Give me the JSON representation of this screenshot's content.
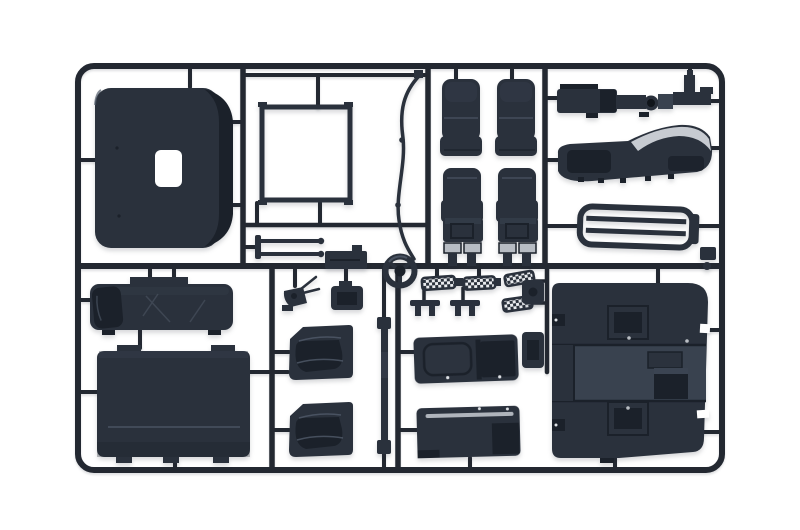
{
  "scene": {
    "type": "photograph",
    "subject": "Plastic scale model kit sprue (injection moulded parts tree) with dark blue-grey styrene truck cab parts on a white background",
    "background": "#ffffff"
  },
  "colors": {
    "background": "#ffffff",
    "runner": "#232831",
    "plastic": "#2a313c",
    "plastic_dark": "#1b212a",
    "plastic_light": "#39424f",
    "sheen": "#515b6a",
    "metal": "#c7cbd1",
    "slider": "#b7bcc3",
    "tread_light": "#e9ebee",
    "tread_dark": "#2a313b"
  },
  "parts": [
    {
      "id": "roof-panel",
      "label": "Cab roof panel with sunroof opening"
    },
    {
      "id": "window-frame",
      "label": "Square window frame seal"
    },
    {
      "id": "thin-rods",
      "label": "Pair of thin wiper-blade rods"
    },
    {
      "id": "small-panel",
      "label": "Small rectangular panel"
    },
    {
      "id": "wiper-rod",
      "label": "Curved antenna / wiper arm rod"
    },
    {
      "id": "steering-wheel",
      "label": "Steering wheel"
    },
    {
      "id": "seat-backrest-left",
      "label": "Seat backrest (left)"
    },
    {
      "id": "seat-backrest-right",
      "label": "Seat backrest (right)"
    },
    {
      "id": "seat-left",
      "label": "Seat with slider base (left)"
    },
    {
      "id": "seat-right",
      "label": "Seat with slider base (right)"
    },
    {
      "id": "chassis-unit",
      "label": "Air tank / chassis cross unit"
    },
    {
      "id": "roof-deflector",
      "label": "Curved roof wind deflector with bright edge"
    },
    {
      "id": "grille",
      "label": "Front grille with horizontal slats"
    },
    {
      "id": "bunk-bed",
      "label": "Sleeper bunk bed with pillow"
    },
    {
      "id": "back-wall",
      "label": "Cab rear wall panel"
    },
    {
      "id": "door-card-upper",
      "label": "Door inner card (upper)"
    },
    {
      "id": "door-card-lower",
      "label": "Door inner card (lower)"
    },
    {
      "id": "trim-strip",
      "label": "Long narrow trim strip"
    },
    {
      "id": "door-shell-upper",
      "label": "Door shell panel (upper)"
    },
    {
      "id": "door-shell-lower",
      "label": "Door shell panel (lower)"
    },
    {
      "id": "cab-floor",
      "label": "Cab floor with engine tunnel and seat platforms"
    },
    {
      "id": "step-plates",
      "label": "Checker tread-plate entry steps (4)"
    },
    {
      "id": "pedal-unit",
      "label": "Pedal unit"
    },
    {
      "id": "seat-base-bracket",
      "label": "Seat base bracket"
    },
    {
      "id": "mount-brackets",
      "label": "Small T-shaped mounting brackets"
    },
    {
      "id": "hinge-blocks",
      "label": "Hinge / mount blocks"
    }
  ]
}
